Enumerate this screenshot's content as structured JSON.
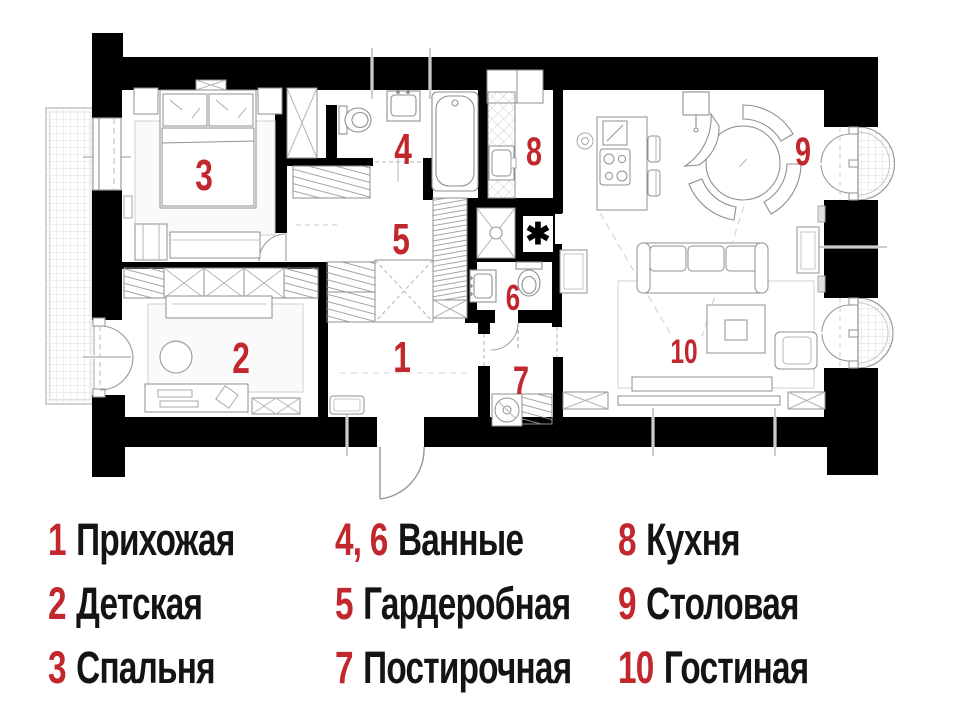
{
  "colors": {
    "accent": "#c1272d",
    "wall": "#000000",
    "line": "#8f8f8f"
  },
  "plan": {
    "star_symbol": "✱",
    "room_numbers": [
      {
        "id": "hallway",
        "num": "1"
      },
      {
        "id": "kids-room",
        "num": "2"
      },
      {
        "id": "bedroom",
        "num": "3"
      },
      {
        "id": "bathroom-1",
        "num": "4"
      },
      {
        "id": "wardrobe",
        "num": "5"
      },
      {
        "id": "bathroom-2",
        "num": "6"
      },
      {
        "id": "laundry",
        "num": "7"
      },
      {
        "id": "kitchen",
        "num": "8"
      },
      {
        "id": "dining",
        "num": "9"
      },
      {
        "id": "living",
        "num": "10"
      }
    ]
  },
  "legend": {
    "columns": [
      {
        "items": [
          {
            "num": "1",
            "label": "Прихожая"
          },
          {
            "num": "2",
            "label": "Детская"
          },
          {
            "num": "3",
            "label": "Спальня"
          }
        ]
      },
      {
        "items": [
          {
            "num": "4, 6",
            "label": "Ванные"
          },
          {
            "num": "5",
            "label": "Гардеробная"
          },
          {
            "num": "7",
            "label": "Постирочная"
          }
        ]
      },
      {
        "items": [
          {
            "num": "8",
            "label": "Кухня"
          },
          {
            "num": "9",
            "label": "Столовая"
          },
          {
            "num": "10",
            "label": "Гостиная"
          }
        ]
      }
    ]
  }
}
